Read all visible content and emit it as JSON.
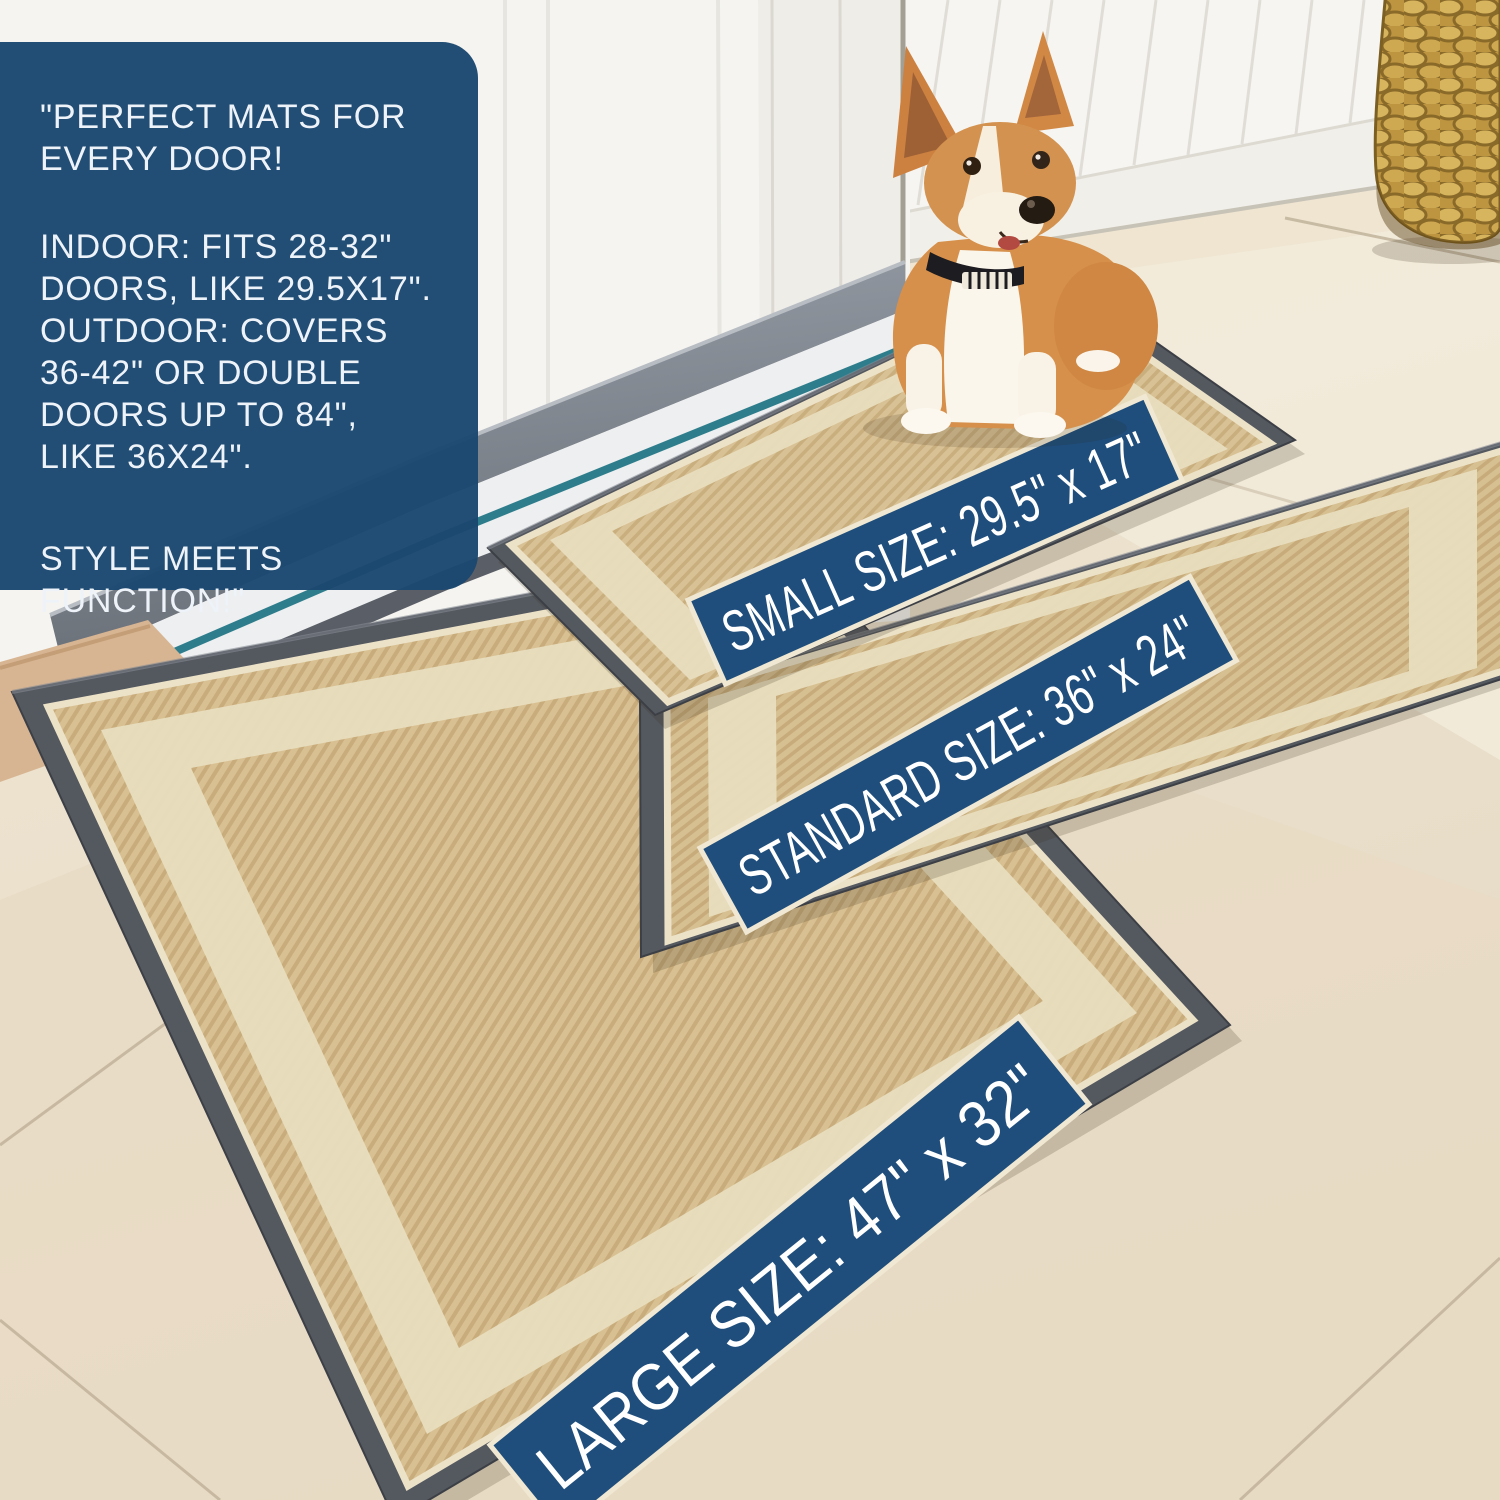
{
  "info_box": {
    "para1": "\"PERFECT MATS FOR EVERY DOOR!",
    "para2": "INDOOR: FITS 28-32\" DOORS, LIKE 29.5X17\". OUTDOOR: COVERS 36-42\" OR DOUBLE DOORS UP TO 84\", LIKE 36X24\".",
    "para3": "STYLE MEETS FUNCTION!\""
  },
  "mats": {
    "small": {
      "label": "SMALL SIZE: 29.5\" x 17\""
    },
    "standard": {
      "label": "STANDARD SIZE: 36\" x 24\""
    },
    "large": {
      "label": "LARGE SIZE: 47\" x 32\""
    }
  },
  "colors": {
    "info_box_bg": "#1b4770",
    "banner_bg": "#1f4e7c",
    "banner_text": "#ffffff",
    "mat_border_gray": "#54585f",
    "mat_field_beige": "#d8c194",
    "mat_inner_ring": "#e8ddbe",
    "threshold_teal": "#2e7d8c",
    "floor_cream": "#e9dfcc"
  }
}
